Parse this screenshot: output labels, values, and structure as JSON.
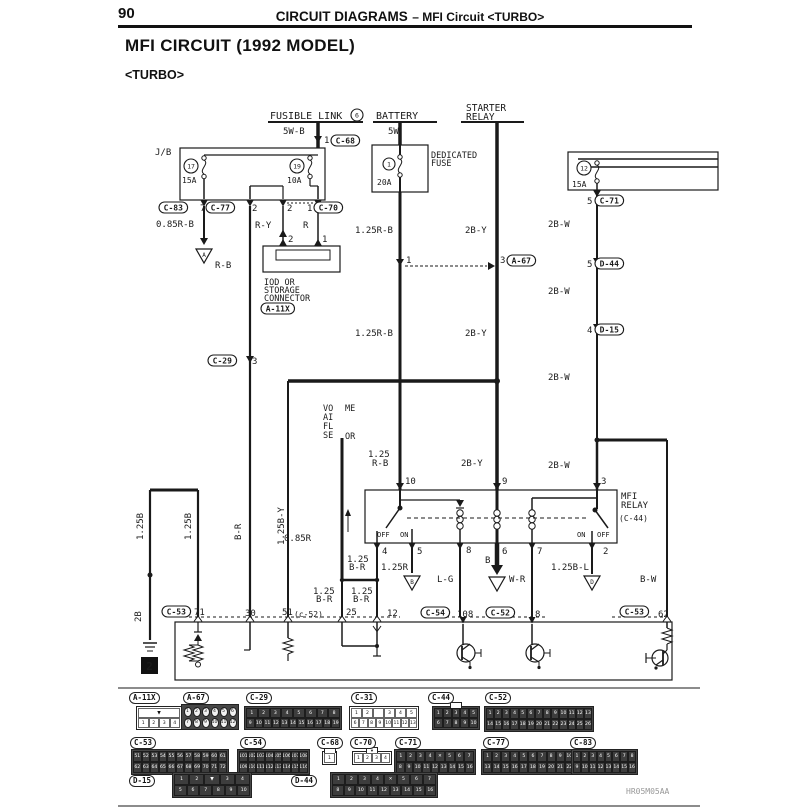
{
  "page": {
    "number": "90",
    "header_left": "CIRCUIT DIAGRAMS",
    "header_right": "– MFI Circuit  <TURBO>",
    "title": "MFI CIRCUIT (1992 MODEL)",
    "subtitle": "<TURBO>",
    "watermark": "HR05M05AA"
  },
  "diagram": {
    "labels": [
      {
        "n": "fusible-link",
        "t": "FUSIBLE LINK",
        "x": 270,
        "y": 119,
        "s": 10
      },
      {
        "n": "wire-5w-b",
        "t": "5W-B",
        "x": 283,
        "y": 134
      },
      {
        "n": "pin-1-c68",
        "t": "1",
        "x": 324,
        "y": 143
      },
      {
        "n": "battery",
        "t": "BATTERY",
        "x": 376,
        "y": 119,
        "s": 10
      },
      {
        "n": "wire-5w",
        "t": "5W",
        "x": 388,
        "y": 134
      },
      {
        "n": "starter-relay-1",
        "t": "STARTER",
        "x": 466,
        "y": 111,
        "s": 9.5
      },
      {
        "n": "starter-relay-2",
        "t": "RELAY",
        "x": 466,
        "y": 120,
        "s": 9.5
      },
      {
        "n": "jb",
        "t": "J/B",
        "x": 155,
        "y": 155
      },
      {
        "n": "fuse17-amp",
        "t": "15A",
        "x": 182,
        "y": 183,
        "s": 8
      },
      {
        "n": "fuse19-amp",
        "t": "10A",
        "x": 287,
        "y": 183,
        "s": 8
      },
      {
        "n": "dedicated-1",
        "t": "DEDICATED",
        "x": 431,
        "y": 158,
        "s": 8.5
      },
      {
        "n": "dedicated-2",
        "t": "FUSE",
        "x": 431,
        "y": 166,
        "s": 8.5
      },
      {
        "n": "fuse1-amp",
        "t": "20A",
        "x": 377,
        "y": 185,
        "s": 8
      },
      {
        "n": "fuse12-amp",
        "t": "15A",
        "x": 572,
        "y": 187,
        "s": 8
      },
      {
        "n": "jb-pin7",
        "t": "7",
        "x": 200,
        "y": 211
      },
      {
        "n": "jb-pin2a",
        "t": "2",
        "x": 252,
        "y": 211
      },
      {
        "n": "jb-pin2b",
        "t": "2",
        "x": 287,
        "y": 211
      },
      {
        "n": "jb-pin1",
        "t": "1",
        "x": 307,
        "y": 211
      },
      {
        "n": "wire-085rb",
        "t": "0.85R-B",
        "x": 156,
        "y": 227
      },
      {
        "n": "wire-ry",
        "t": "R-Y",
        "x": 255,
        "y": 228
      },
      {
        "n": "wire-r",
        "t": "R",
        "x": 303,
        "y": 228
      },
      {
        "n": "wire-rb",
        "t": "R-B",
        "x": 215,
        "y": 268
      },
      {
        "n": "iod-pin2",
        "t": "2",
        "x": 288,
        "y": 242
      },
      {
        "n": "iod-pin1",
        "t": "1",
        "x": 322,
        "y": 242
      },
      {
        "n": "iod-1",
        "t": "IOD OR",
        "x": 264,
        "y": 285,
        "s": 8.5
      },
      {
        "n": "iod-2",
        "t": "STORAGE",
        "x": 264,
        "y": 293,
        "s": 8.5
      },
      {
        "n": "iod-3",
        "t": "CONNECTOR",
        "x": 264,
        "y": 301,
        "s": 8.5
      },
      {
        "n": "wire-125rb-1",
        "t": "1.25R-B",
        "x": 355,
        "y": 233
      },
      {
        "n": "wire-2by-1",
        "t": "2B-Y",
        "x": 465,
        "y": 233
      },
      {
        "n": "junction-pin1",
        "t": "1",
        "x": 406,
        "y": 263
      },
      {
        "n": "junction-pin3",
        "t": "3",
        "x": 500,
        "y": 263
      },
      {
        "n": "rcol-pin5a",
        "t": "5",
        "x": 587,
        "y": 204
      },
      {
        "n": "wire-2bw-1",
        "t": "2B-W",
        "x": 548,
        "y": 227
      },
      {
        "n": "rcol-pin5b",
        "t": "5",
        "x": 587,
        "y": 267
      },
      {
        "n": "wire-2bw-2",
        "t": "2B-W",
        "x": 548,
        "y": 294
      },
      {
        "n": "rcol-pin4",
        "t": "4",
        "x": 587,
        "y": 333
      },
      {
        "n": "wire-2bw-3",
        "t": "2B-W",
        "x": 548,
        "y": 380
      },
      {
        "n": "wire-125rb-2",
        "t": "1.25R-B",
        "x": 355,
        "y": 336
      },
      {
        "n": "wire-2by-2",
        "t": "2B-Y",
        "x": 465,
        "y": 336
      },
      {
        "n": "wire-2bw-4",
        "t": "2B-W",
        "x": 548,
        "y": 468
      },
      {
        "n": "vafs-1",
        "t": "VO",
        "x": 323,
        "y": 411,
        "s": 8.5
      },
      {
        "n": "vafs-2",
        "t": "ME",
        "x": 345,
        "y": 411,
        "s": 8.5
      },
      {
        "n": "vafs-3",
        "t": "AI",
        "x": 323,
        "y": 420,
        "s": 8.5
      },
      {
        "n": "vafs-4",
        "t": "FL",
        "x": 323,
        "y": 429,
        "s": 8.5
      },
      {
        "n": "vafs-5",
        "t": "SE",
        "x": 323,
        "y": 438,
        "s": 8.5
      },
      {
        "n": "vafs-6",
        "t": "OR",
        "x": 345,
        "y": 439,
        "s": 8.5
      },
      {
        "n": "wire-125rb-relay-a",
        "t": "1.25",
        "x": 368,
        "y": 457
      },
      {
        "n": "wire-125rb-relay-b",
        "t": "R-B",
        "x": 372,
        "y": 466
      },
      {
        "n": "wire-2by-3",
        "t": "2B-Y",
        "x": 461,
        "y": 466
      },
      {
        "n": "relay-pin10",
        "t": "10",
        "x": 405,
        "y": 484
      },
      {
        "n": "relay-pin9",
        "t": "9",
        "x": 502,
        "y": 484
      },
      {
        "n": "relay-pin3",
        "t": "3",
        "x": 601,
        "y": 484
      },
      {
        "n": "mfi-relay-1",
        "t": "MFI",
        "x": 621,
        "y": 499
      },
      {
        "n": "mfi-relay-2",
        "t": "RELAY",
        "x": 621,
        "y": 508
      },
      {
        "n": "mfi-relay-ref",
        "t": "(C-44)",
        "x": 619,
        "y": 521,
        "s": 8
      },
      {
        "n": "switch-off-left",
        "t": "OFF",
        "x": 377,
        "y": 537,
        "s": 7
      },
      {
        "n": "switch-on-left",
        "t": "ON",
        "x": 400,
        "y": 537,
        "s": 7
      },
      {
        "n": "switch-on-right",
        "t": "ON",
        "x": 577,
        "y": 537,
        "s": 7
      },
      {
        "n": "switch-off-right",
        "t": "OFF",
        "x": 597,
        "y": 537,
        "s": 7
      },
      {
        "n": "relay-pin4",
        "t": "4",
        "x": 382,
        "y": 554
      },
      {
        "n": "relay-pin5",
        "t": "5",
        "x": 417,
        "y": 554
      },
      {
        "n": "relay-pin8",
        "t": "8",
        "x": 466,
        "y": 553
      },
      {
        "n": "relay-pin6",
        "t": "6",
        "x": 502,
        "y": 554
      },
      {
        "n": "relay-pin7",
        "t": "7",
        "x": 537,
        "y": 554
      },
      {
        "n": "relay-pin2",
        "t": "2",
        "x": 603,
        "y": 554
      },
      {
        "n": "wire-125br-1a",
        "t": "1.25",
        "x": 347,
        "y": 562
      },
      {
        "n": "wire-125br-1b",
        "t": "B-R",
        "x": 349,
        "y": 570
      },
      {
        "n": "wire-125r",
        "t": "1.25R",
        "x": 381,
        "y": 570
      },
      {
        "n": "wire-lg",
        "t": "L-G",
        "x": 437,
        "y": 582
      },
      {
        "n": "wire-b",
        "t": "B",
        "x": 485,
        "y": 563
      },
      {
        "n": "wire-wr",
        "t": "W-R",
        "x": 509,
        "y": 582
      },
      {
        "n": "wire-125bl",
        "t": "1.25B-L",
        "x": 551,
        "y": 570
      },
      {
        "n": "wire-bw",
        "t": "B-W",
        "x": 640,
        "y": 582
      },
      {
        "n": "wire-085r",
        "t": "0.85R",
        "x": 284,
        "y": 541
      },
      {
        "n": "wire-125br-2a",
        "t": "1.25",
        "x": 351,
        "y": 594
      },
      {
        "n": "wire-125br-2b",
        "t": "B-R",
        "x": 353,
        "y": 602
      },
      {
        "n": "wire-125br-3a",
        "t": "1.25",
        "x": 313,
        "y": 594
      },
      {
        "n": "wire-125br-3b",
        "t": "B-R",
        "x": 316,
        "y": 602
      },
      {
        "n": "ecu-pin71",
        "t": "71",
        "x": 194,
        "y": 615
      },
      {
        "n": "ecu-pin30",
        "t": "30",
        "x": 245,
        "y": 616
      },
      {
        "n": "ecu-pin51",
        "t": "51",
        "x": 282,
        "y": 615
      },
      {
        "n": "ref-c52-small",
        "t": "(c-52)",
        "x": 294,
        "y": 617,
        "s": 8
      },
      {
        "n": "ecu-pin25",
        "t": "25",
        "x": 346,
        "y": 615
      },
      {
        "n": "ecu-pin12",
        "t": "12",
        "x": 387,
        "y": 616
      },
      {
        "n": "ecu-pin108",
        "t": "108",
        "x": 457,
        "y": 617
      },
      {
        "n": "ecu-pin8",
        "t": "8",
        "x": 535,
        "y": 617
      },
      {
        "n": "ecu-pin62",
        "t": "62",
        "x": 658,
        "y": 617
      },
      {
        "n": "c29-pin3",
        "t": "3",
        "x": 252,
        "y": 364
      },
      {
        "n": "wire-125b-1",
        "t": "1.25B",
        "x": 143,
        "y": 540,
        "r": 1
      },
      {
        "n": "wire-125b-2",
        "t": "1.25B",
        "x": 191,
        "y": 540,
        "r": 1
      },
      {
        "n": "wire-br-rot",
        "t": "B-R",
        "x": 241,
        "y": 540,
        "r": 1
      },
      {
        "n": "wire-125by-rot",
        "t": "1.25B-Y",
        "x": 284,
        "y": 545,
        "r": 1
      },
      {
        "n": "wire-2b-rot",
        "t": "2B",
        "x": 141,
        "y": 622,
        "r": 1
      }
    ],
    "refs": [
      {
        "t": "C-68",
        "x": 331,
        "y": 135
      },
      {
        "t": "C-83",
        "x": 159,
        "y": 202
      },
      {
        "t": "C-77",
        "x": 206,
        "y": 202
      },
      {
        "t": "C-70",
        "x": 314,
        "y": 202
      },
      {
        "t": "A-11X",
        "x": 261,
        "y": 303
      },
      {
        "t": "C-29",
        "x": 208,
        "y": 355
      },
      {
        "t": "A-67",
        "x": 507,
        "y": 255
      },
      {
        "t": "C-71",
        "x": 595,
        "y": 195
      },
      {
        "t": "D-44",
        "x": 595,
        "y": 258
      },
      {
        "t": "D-15",
        "x": 595,
        "y": 324
      },
      {
        "t": "C-53",
        "x": 162,
        "y": 606
      },
      {
        "t": "C-54",
        "x": 421,
        "y": 607
      },
      {
        "t": "C-52",
        "x": 486,
        "y": 607
      },
      {
        "t": "C-53",
        "x": 620,
        "y": 606
      }
    ],
    "circled": [
      {
        "t": "6",
        "x": 357,
        "y": 115,
        "r": 6
      },
      {
        "t": "17",
        "x": 191,
        "y": 166,
        "r": 7
      },
      {
        "t": "19",
        "x": 297,
        "y": 166,
        "r": 7
      },
      {
        "t": "1",
        "x": 389,
        "y": 164,
        "r": 6
      },
      {
        "t": "12",
        "x": 584,
        "y": 168,
        "r": 7
      }
    ],
    "grounds": [
      {
        "t": "A",
        "x": 204,
        "y": 249
      },
      {
        "t": "B",
        "x": 412,
        "y": 576
      },
      {
        "t": "",
        "x": 497,
        "y": 577
      },
      {
        "t": "D",
        "x": 592,
        "y": 576
      }
    ],
    "black_box": {
      "t": "2",
      "x": 141,
      "y": 657
    }
  },
  "connector_panel": {
    "items": [
      {
        "id": "A-11X",
        "lx": 129,
        "ly": 692,
        "x": 136,
        "y": 706,
        "w": 46,
        "h": 24,
        "rows": [
          [
            "▼"
          ],
          [
            "1",
            "2",
            "3",
            "4"
          ]
        ]
      },
      {
        "id": "A-67",
        "lx": 183,
        "ly": 692,
        "x": 181,
        "y": 704,
        "w": 58,
        "h": 26,
        "dark": 1,
        "circle": 1,
        "rows": [
          [
            "1",
            "2",
            "3",
            "4",
            "5",
            "6"
          ],
          [
            "7",
            "8",
            "9",
            "10",
            "11",
            "12"
          ]
        ]
      },
      {
        "id": "C-29",
        "lx": 246,
        "ly": 692,
        "x": 244,
        "y": 706,
        "w": 98,
        "h": 24,
        "dark": 1,
        "rows": [
          [
            "1",
            "2",
            "3",
            "4",
            "5",
            "6",
            "7",
            "8"
          ],
          [
            "9",
            "10",
            "11",
            "12",
            "13",
            "14",
            "15",
            "16",
            "17",
            "18",
            "19"
          ]
        ]
      },
      {
        "id": "C-31",
        "lx": 351,
        "ly": 692,
        "x": 349,
        "y": 706,
        "w": 70,
        "h": 24,
        "rows": [
          [
            "1",
            "2",
            "",
            "3",
            "4",
            "5"
          ],
          [
            "6",
            "7",
            "8",
            "9",
            "10",
            "11",
            "12",
            "13"
          ]
        ]
      },
      {
        "id": "C-44",
        "lx": 428,
        "ly": 692,
        "x": 432,
        "y": 706,
        "w": 48,
        "h": 24,
        "dark": 1,
        "latch": 1,
        "rows": [
          [
            "1",
            "2",
            "3",
            "4",
            "5"
          ],
          [
            "6",
            "7",
            "8",
            "9",
            "10"
          ]
        ]
      },
      {
        "id": "C-52",
        "lx": 485,
        "ly": 692,
        "x": 484,
        "y": 706,
        "w": 110,
        "h": 26,
        "dark": 1,
        "rows": [
          [
            "1",
            "2",
            "3",
            "4",
            "5",
            "6",
            "7",
            "8",
            "9",
            "10",
            "11",
            "12",
            "13"
          ],
          [
            "14",
            "15",
            "16",
            "17",
            "18",
            "19",
            "20",
            "21",
            "22",
            "23",
            "24",
            "25",
            "26"
          ]
        ]
      },
      {
        "id": "C-53",
        "lx": 130,
        "ly": 737,
        "x": 131,
        "y": 749,
        "w": 98,
        "h": 26,
        "dark": 1,
        "rows": [
          [
            "51",
            "52",
            "53",
            "54",
            "55",
            "56",
            "57",
            "58",
            "59",
            "60",
            "61"
          ],
          [
            "62",
            "63",
            "64",
            "65",
            "66",
            "67",
            "68",
            "69",
            "70",
            "71",
            "72"
          ]
        ]
      },
      {
        "id": "C-54",
        "lx": 240,
        "ly": 737,
        "x": 237,
        "y": 749,
        "w": 73,
        "h": 26,
        "dark": 1,
        "rows": [
          [
            "101",
            "102",
            "103",
            "104",
            "105",
            "106",
            "107",
            "108"
          ],
          [
            "109",
            "110",
            "111",
            "112",
            "113",
            "114",
            "115",
            "116"
          ]
        ]
      },
      {
        "id": "C-68",
        "lx": 317,
        "ly": 737,
        "x": 322,
        "y": 751,
        "w": 15,
        "h": 14,
        "latch": 1,
        "rows": [
          [
            "1"
          ]
        ]
      },
      {
        "id": "C-70",
        "lx": 350,
        "ly": 737,
        "x": 352,
        "y": 751,
        "w": 40,
        "h": 14,
        "latch": "▼",
        "rows": [
          [
            "1",
            "2",
            "3",
            "4"
          ]
        ]
      },
      {
        "id": "C-71",
        "lx": 395,
        "ly": 737,
        "x": 394,
        "y": 749,
        "w": 82,
        "h": 26,
        "dark": 1,
        "rows": [
          [
            "1",
            "2",
            "3",
            "4",
            "✕",
            "5",
            "6",
            "7"
          ],
          [
            "8",
            "9",
            "10",
            "11",
            "12",
            "13",
            "14",
            "15",
            "16"
          ]
        ]
      },
      {
        "id": "C-77",
        "lx": 483,
        "ly": 737,
        "x": 481,
        "y": 749,
        "w": 113,
        "h": 26,
        "dark": 1,
        "rows": [
          [
            "1",
            "2",
            "3",
            "4",
            "5",
            "6",
            "7",
            "8",
            "9",
            "10",
            "11",
            "12"
          ],
          [
            "13",
            "14",
            "15",
            "16",
            "17",
            "18",
            "19",
            "20",
            "21",
            "22",
            "23",
            "24"
          ]
        ]
      },
      {
        "id": "C-83",
        "lx": 570,
        "ly": 737,
        "x": 571,
        "y": 749,
        "w": 67,
        "h": 26,
        "dark": 1,
        "rows": [
          [
            "1",
            "2",
            "3",
            "4",
            "5",
            "6",
            "7",
            "8"
          ],
          [
            "9",
            "10",
            "11",
            "12",
            "13",
            "14",
            "15",
            "16"
          ]
        ]
      },
      {
        "id": "D-15",
        "lx": 129,
        "ly": 775,
        "x": 172,
        "y": 772,
        "w": 80,
        "h": 26,
        "dark": 1,
        "rows": [
          [
            "1",
            "2",
            "▼",
            "3",
            "4"
          ],
          [
            "5",
            "6",
            "7",
            "8",
            "9",
            "10"
          ]
        ]
      },
      {
        "id": "D-44",
        "lx": 291,
        "ly": 775,
        "x": 330,
        "y": 772,
        "w": 108,
        "h": 26,
        "dark": 1,
        "rows": [
          [
            "1",
            "2",
            "3",
            "4",
            "✕",
            "5",
            "6",
            "7"
          ],
          [
            "8",
            "9",
            "10",
            "11",
            "12",
            "13",
            "14",
            "15",
            "16"
          ]
        ]
      }
    ]
  }
}
